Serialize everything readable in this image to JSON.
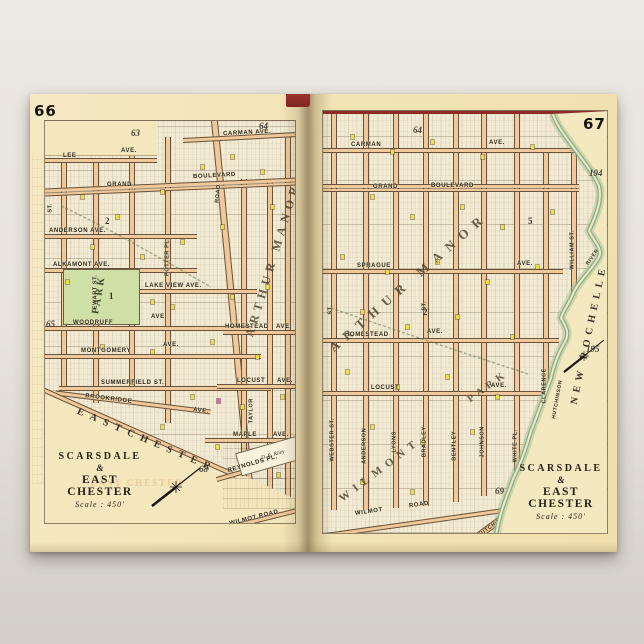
{
  "poster": {
    "bg_top": "#ece8e2",
    "bg_bottom": "#d3cfc8",
    "sheet": "#f3e4b6",
    "accent_red": "#8c2b26",
    "park_green": "#cfe0a6",
    "river_green": "#86ae8c",
    "building_yellow": "#e9e042",
    "building_pink": "#d9699f"
  },
  "left": {
    "page_number": "66",
    "refs": {
      "r63": "63",
      "r64": "64",
      "r65": "65",
      "r68": "68"
    },
    "title": {
      "t1": "SCARSDALE",
      "amp": "&",
      "t2": "EAST CHESTER",
      "scale": "Scale : 450'"
    },
    "district": "ARTHUR MANOR",
    "park": "PARK",
    "park_no": "1",
    "block2": "2",
    "boundary": "EASTCHESTER",
    "parcel": "D. R. Riley",
    "ghost": "EAST CHESTER",
    "streets": {
      "lee": "LEE",
      "lee_ave": "AVE.",
      "carman": "CARMAN AVE.",
      "grand": "GRAND",
      "boulevard": "BOULEVARD",
      "anderson": "ANDERSON AVE.",
      "alkamont": "ALKAMONT AVE.",
      "lakeview": "LAKE VIEW AVE.",
      "woodruff": "WOODRUFF",
      "woodruff_ave": "AVE.",
      "montgomery": "MONTGOMERY",
      "montgomery_ave": "AVE.",
      "summerfield": "SUMMERFIELD ST.",
      "brookridge": "BROOKRIDGE",
      "brookridge_ave": "AVE.",
      "homestead": "HOMESTEAD",
      "homestead_ave": "AVE.",
      "locust": "LOCUST",
      "locust_ave": "AVE.",
      "maple": "MAPLE",
      "maple_ave": "AVE.",
      "reynolds": "REYNOLDS PL.",
      "wilmot": "WILMOT ROAD",
      "ewart": "EWART ST.",
      "potter": "POTTER PL.",
      "road": "ROAD",
      "taylor": "TAYLOR",
      "st": "ST."
    }
  },
  "right": {
    "page_number": "67",
    "refs": {
      "r64": "64",
      "r194": "194",
      "r195": "195",
      "r69": "69"
    },
    "title": {
      "t1": "SCARSDALE",
      "amp": "&",
      "t2": "EAST CHESTER",
      "scale": "Scale : 450'"
    },
    "district": "ARTHUR MANOR",
    "district2": "WILMONT",
    "district3": "PARK",
    "boundary": "NEW ROCHELLE",
    "river": {
      "n1": "HUTCHINSON",
      "n2": "RIVER"
    },
    "block5": "5",
    "block2": "2",
    "streets": {
      "carman": "CARMAN",
      "carman_ave": "AVE.",
      "grand": "GRAND",
      "boulevard": "BOULEVARD",
      "sprague": "SPRAGUE",
      "sprague_ave": "AVE.",
      "homestead": "HOMESTEAD",
      "homestead_ave": "AVE.",
      "locust": "LOCUST",
      "locust_ave": "AVE.",
      "wilmot": "WILMOT",
      "wilmot_road": "ROAD",
      "hutchinson": "HUTCHINSON",
      "hutchinson_blvd": "BOULEVARD",
      "webster": "WEBSTER ST.",
      "anderson": "ANDERSON",
      "lyons": "LYONS",
      "bradley": "BRADLEY",
      "bentley": "BENTLEY",
      "johnson": "JOHNSON",
      "white": "WHITE PL.",
      "clarence": "CLARENCE",
      "william": "WILLIAM ST.",
      "st": "ST."
    }
  }
}
